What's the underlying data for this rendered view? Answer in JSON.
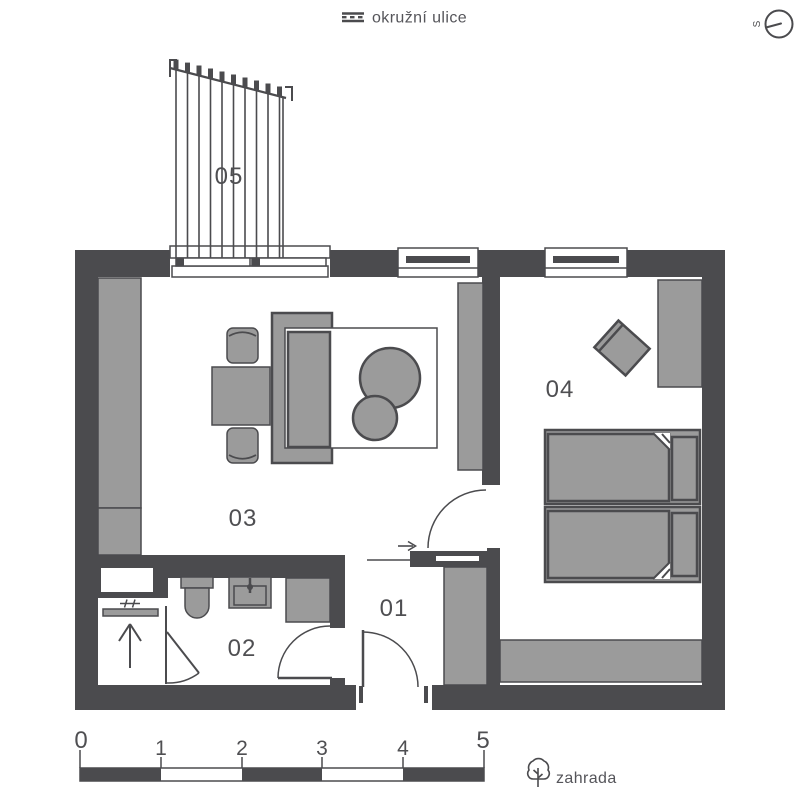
{
  "street": {
    "label": "okružní ulice",
    "icon": "street-lines-icon"
  },
  "compass": {
    "letter": "S",
    "icon": "compass-icon"
  },
  "room_labels": {
    "hall": "01",
    "bathroom": "02",
    "living_room": "03",
    "bedroom": "04",
    "pergola": "05"
  },
  "scale_bar": {
    "ticks": [
      "0",
      "1",
      "2",
      "3",
      "4",
      "5"
    ]
  },
  "garden": {
    "label": "zahrada",
    "icon": "tree-icon"
  },
  "colors": {
    "wall": "#4b4b4e",
    "furniture": "#9b9b9b",
    "line": "#4b4b4e",
    "background": "#ffffff",
    "label_text": "#4f4f52"
  }
}
